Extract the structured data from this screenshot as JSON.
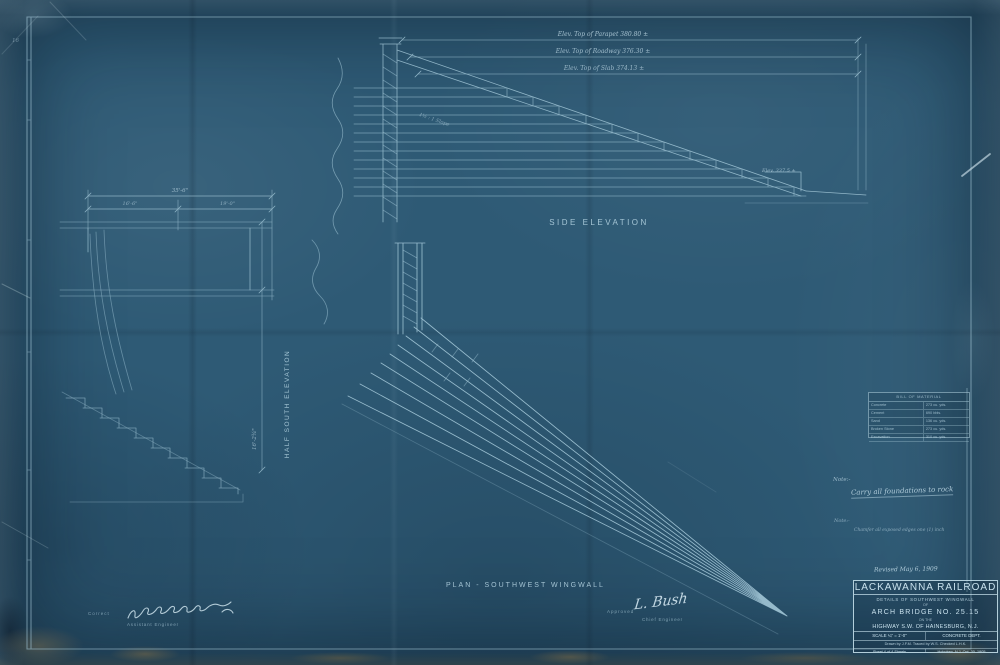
{
  "sheet": {
    "margin_number": "16",
    "revised_note": "Revised May 6, 1909"
  },
  "views": {
    "side_elevation": {
      "label": "SIDE ELEVATION",
      "elev_parapet": "Elev. Top of Parapet   380.80 ±",
      "elev_roadway": "Elev. Top of Roadway   376.30 ±",
      "elev_slab": "Elev. Top of Slab   374.13 ±",
      "toe_elevation": "Elev. 337.5 ±",
      "slope_note": "1½ : 1 Slope"
    },
    "half_south_elevation": {
      "label": "HALF SOUTH ELEVATION",
      "dim_overall": "35'-6\"",
      "dim_left": "16'-6\"",
      "dim_right": "19'-0\"",
      "dim_height": "16'-2¾\""
    },
    "plan": {
      "label": "PLAN - SOUTHWEST WINGWALL"
    }
  },
  "notes": {
    "note1_label": "Note:-",
    "note1_text": "Carry all foundations to rock",
    "note2_label": "Note:-",
    "note2_text": "Chamfer all exposed edges one (1) inch"
  },
  "bill_of_material": {
    "title": "BILL OF MATERIAL",
    "rows": [
      {
        "item": "Concrete",
        "qty": "273 cu. yds."
      },
      {
        "item": "Cement",
        "qty": "690 bbls."
      },
      {
        "item": "Sand",
        "qty": "136 cu. yds."
      },
      {
        "item": "Broken Stone",
        "qty": "273 cu. yds."
      },
      {
        "item": "Excavation",
        "qty": "310 cu. yds."
      }
    ]
  },
  "title_block": {
    "railroad": "LACKAWANNA RAILROAD",
    "detail_line1": "DETAILS OF SOUTHWEST WINGWALL",
    "detail_line2": "OF",
    "bridge_line": "ARCH BRIDGE NO. 25.15",
    "conj_line": "ON THE",
    "location_line": "HIGHWAY S.W. OF HAINESBURG, N.J.",
    "scale": "SCALE ¼\" = 1'-0\"",
    "dept": "CONCRETE DEPT.",
    "credits": "Drawn by J.F.M.   Traced by W.S.   Checked  L.H.K.",
    "sheet_info": "Sheet 4 of 4 Sheets",
    "place_date": "Hoboken, N.J.  Oct. 30, 1905"
  },
  "approvals": {
    "correct_label": "Correct",
    "assistant_title": "Assistant Engineer",
    "approved_label": "Approved",
    "chief_signature": "L. Bush",
    "chief_title": "Chief Engineer"
  }
}
